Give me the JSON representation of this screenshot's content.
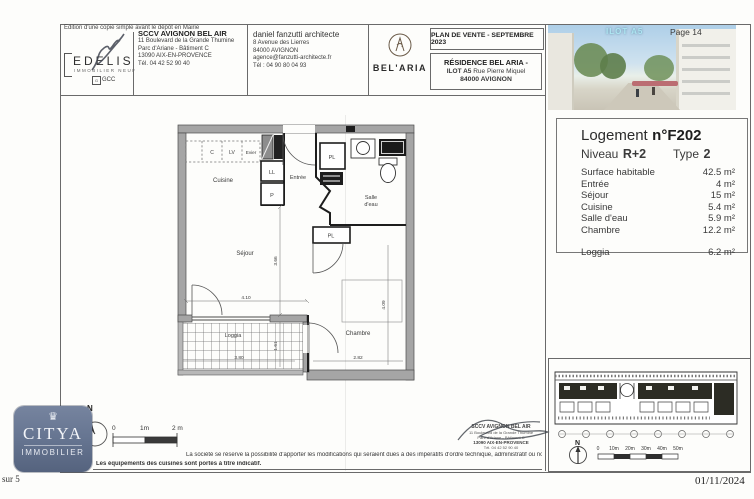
{
  "page": {
    "edition_note": "Edition d'une copie simple avant le dépôt en Mairie",
    "page_number": "Page 14",
    "sheet_of": "sur 5",
    "date": "01/11/2024"
  },
  "header": {
    "edelis": {
      "brand": "EDELIS",
      "tagline": "IMMOBILIER NEUF",
      "group": "GCC"
    },
    "promoter": {
      "name": "SCCV AVIGNON BEL AIR",
      "line1": "11 Boulevard de la Grande Thumine",
      "line2": "Parc d'Ariane - Bâtiment C",
      "line3": "13090 AIX-EN-PROVENCE",
      "line4": "Tél. 04 42 52 90 40"
    },
    "architect": {
      "name": "daniel fanzutti architecte",
      "line1": "8 Avenue des Lierres",
      "line2": "84000 AVIGNON",
      "line3": "agence@fanzutti-architecte.fr",
      "line4": "Tél : 04 90 80 04 93"
    },
    "brand": {
      "name": "BEL'ARIA"
    },
    "plan_box": {
      "title": "PLAN DE VENTE - SEPTEMBRE 2023",
      "residence": "RÉSIDENCE BEL ARIA  -",
      "ilot": "ILOT A5",
      "street": "Rue Pierre Miquel",
      "city": "84000 AVIGNON"
    },
    "photo_label": "ILOT A5"
  },
  "unit_panel": {
    "title_label": "Logement",
    "unit_number": "n°F202",
    "level_label": "Niveau",
    "level_value": "R+2",
    "type_label": "Type",
    "type_value": "2",
    "rows": [
      {
        "label": "Surface habitable",
        "value": "42.5 m²"
      },
      {
        "label": "Entrée",
        "value": "4 m²"
      },
      {
        "label": "Séjour",
        "value": "15 m²"
      },
      {
        "label": "Cuisine",
        "value": "5.4 m²"
      },
      {
        "label": "Salle d'eau",
        "value": "5.9 m²"
      },
      {
        "label": "Chambre",
        "value": "12.2 m²"
      }
    ],
    "loggia": {
      "label": "Loggia",
      "value": "6.2 m²"
    }
  },
  "floorplan": {
    "rooms": {
      "cuisine": "Cuisine",
      "entree": "Entrée",
      "sejour": "Séjour",
      "salle_line1": "Salle",
      "salle_line2": "d'eau",
      "chambre": "Chambre",
      "loggia": "Loggia"
    },
    "fixtures": {
      "c": "C",
      "lv": "LV",
      "evier": "Evier",
      "ll": "LL",
      "p": "P",
      "pl_entree": "PL",
      "pl_chambre": "PL"
    },
    "dims": {
      "sejour_width": "4.10",
      "sejour_height": "3.66",
      "loggia_width": "3.80",
      "loggia_height": "1.61",
      "chambre_width": "2.82",
      "chambre_height": "4.09"
    },
    "north_label": "N",
    "scale": {
      "zero": "0",
      "mid": "1m",
      "end": "2 m"
    }
  },
  "footer": {
    "disclaimer_line1": "La société se réserve la possibilité d'apporter les modifications qui seraient dues à des impératifs d'ordre technique, administratif ou normatif.",
    "disclaimer_line2": "Les équipements des cuisines sont portés à titre indicatif.",
    "stamp": {
      "name": "SCCV AVIGNON BEL AIR",
      "line1": "11 Boulevard de la Grande Thumine",
      "line2": "Parc d'Ariane - Bâtiment C",
      "line3": "13090 AIX-EN-PROVENCE",
      "line4": "Tél. 04 42 52 90 40"
    },
    "agency": {
      "brand": "CITYA",
      "division": "IMMOBILIER"
    }
  },
  "siteplan": {
    "north_label": "N",
    "scale_labels": [
      "0",
      "10m",
      "20m",
      "30m",
      "40m",
      "50m"
    ]
  }
}
